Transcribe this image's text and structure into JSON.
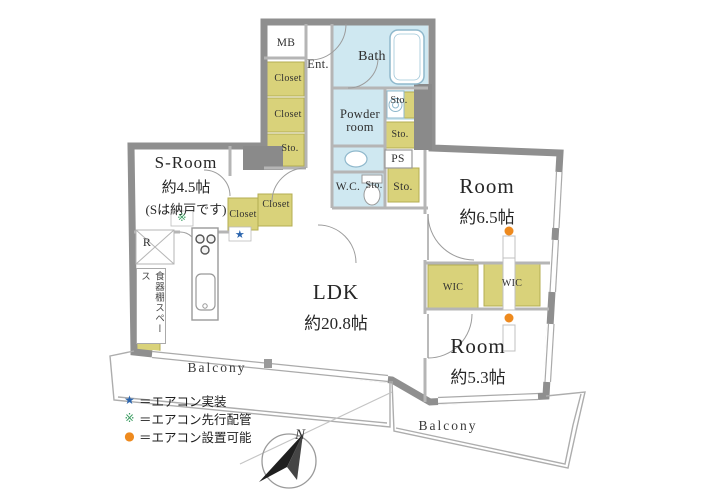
{
  "labels": {
    "mb": "MB",
    "ent": "Ent.",
    "closet": "Closet",
    "sto": "Sto.",
    "bath": "Bath",
    "powder_line1": "Powder",
    "powder_line2": "room",
    "wc": "W.C.",
    "ps": "PS",
    "wic": "WIC",
    "r": "R",
    "dish_space": "食器棚スペース",
    "balcony": "Balcony",
    "north": "N"
  },
  "rooms": {
    "s_room": {
      "name": "S-Room",
      "area": "約4.5帖",
      "note": "(Sは納戸です)"
    },
    "ldk": {
      "name": "LDK",
      "area": "約20.8帖"
    },
    "room_upper": {
      "name": "Room",
      "area": "約6.5帖"
    },
    "room_lower": {
      "name": "Room",
      "area": "約5.3帖"
    }
  },
  "markers": {
    "aircon_installed": "★",
    "aircon_piping": "※",
    "aircon_possible": "●"
  },
  "legend": {
    "items": [
      {
        "symbol": "star",
        "glyph": "★",
        "color": "#2a64ad",
        "label": "＝エアコン実装"
      },
      {
        "symbol": "asterisk",
        "glyph": "※",
        "color": "#3d9e63",
        "label": "＝エアコン先行配管"
      },
      {
        "symbol": "circle",
        "glyph": "●",
        "color": "#ee8a1e",
        "label": "＝エアコン設置可能"
      }
    ]
  },
  "colors": {
    "wall": "#8f8f8f",
    "wet_area": "#cfe8f1",
    "storage": "#d9d27a",
    "marker_star": "#2a64ad",
    "marker_asterisk": "#3d9e63",
    "marker_circle": "#ee8a1e"
  }
}
